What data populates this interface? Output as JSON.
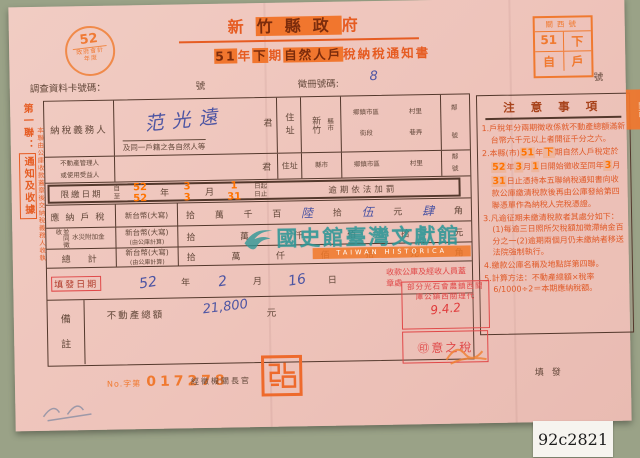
{
  "catalog_label": "92c2821",
  "stamp_52": {
    "number": "52",
    "line1": "政府會計",
    "line2": "年度"
  },
  "header": {
    "title_segs": [
      {
        "t": "新",
        "h": false
      },
      {
        "t": "竹縣政",
        "h": true
      },
      {
        "t": "府",
        "h": false
      }
    ],
    "subtitle_segs": [
      {
        "t": "51",
        "h": true
      },
      {
        "t": "年",
        "h": false
      },
      {
        "t": "下",
        "h": true
      },
      {
        "t": "期",
        "h": false
      },
      {
        "t": "自然人戶",
        "h": true
      },
      {
        "t": "稅納稅通知書",
        "h": false
      }
    ]
  },
  "corner_box": {
    "row1": "關西號",
    "r2a": "51",
    "r2b": "下",
    "r3a": "自",
    "r3b": "戶"
  },
  "card_row": {
    "label": "調查資料卡號碼：",
    "no1": "號",
    "reg_label": "徵冊號碼:",
    "reg_value": "8",
    "no2": "號"
  },
  "left_strip": {
    "part1": "第一聯：",
    "part2": "通知及收據",
    "sub": "本聯由公庫收款蓋章後交納稅義務人收執"
  },
  "form": {
    "taxpayer": {
      "label": "納稅義務人",
      "name": "范光遠",
      "jun": "君",
      "note": "及同一戶籍之各自然人等"
    },
    "addr": {
      "label": "住址",
      "city": "新竹",
      "city_unit": "縣市",
      "u1": "鄉鎮市區",
      "u2": "街段",
      "u3": "村里",
      "u4": "巷弄",
      "lin": "鄰",
      "hao": "號"
    },
    "manager": {
      "label1": "不動產管理人",
      "label2": "或使用受益人",
      "jun": "君",
      "addr_label": "住址",
      "city_unit": "縣市",
      "u1": "鄉鎮市區",
      "u2": "街段",
      "u3": "村里",
      "u4": "巷弄",
      "lin": "鄰",
      "hao": "號"
    },
    "deadline": {
      "label": "限繳日期",
      "from": "自",
      "to": "至",
      "year_from": "52",
      "year_to": "52",
      "y": "年",
      "month_from": "3",
      "month_to": "3",
      "m": "月",
      "day_from": "1",
      "day_to": "31",
      "suffix_from": "日起",
      "suffix_to": "日止",
      "penalty": "逾期依法加罰"
    },
    "tax_row": {
      "label": "應納戶稅",
      "currency": "新台幣(大寫)",
      "u1": "拾",
      "u2": "萬",
      "u3": "千",
      "u4": "百",
      "hw1": "陸",
      "u5": "拾",
      "hw2": "伍",
      "u6": "元",
      "hw3": "肆",
      "u7": "角"
    },
    "surtax_row": {
      "label_a": "並同徵收",
      "label_b": "水災附加金",
      "currency": "新台幣(大寫)",
      "currency2": "(由公庫計算)",
      "units": [
        "拾",
        "萬",
        "仟",
        "佰",
        "拾",
        "元"
      ]
    },
    "total_row": {
      "label": "總　計",
      "currency": "新台幣(大寫)",
      "currency2": "(由公庫計算)",
      "units": [
        "拾",
        "萬",
        "仟",
        "佰",
        "拾",
        "元",
        "角"
      ]
    },
    "issue": {
      "label": "填發日期",
      "year_hw": "52",
      "y": "年",
      "month_hw": "2",
      "m": "月",
      "day_hw": "16",
      "d": "日",
      "right_label": "收款公庫及經收人員蓋章處"
    },
    "remark": {
      "label1": "備",
      "label2": "註",
      "text": "不動產總額",
      "value_hw": "21,800",
      "unit": "元"
    }
  },
  "notes": {
    "title": "注 意 事 項",
    "items": [
      [
        {
          "t": "1.戶稅年分兩期徵收係就不動產總額滿新台幣六千元以上者開征千分之六。",
          "h": false
        }
      ],
      [
        {
          "t": "2.本縣(市)",
          "h": false
        },
        {
          "t": "51",
          "h": true
        },
        {
          "t": "年",
          "h": false
        },
        {
          "t": "下",
          "h": true
        },
        {
          "t": "期自然人戶稅定於",
          "h": false
        },
        {
          "t": "52",
          "h": true
        },
        {
          "t": "年",
          "h": false
        },
        {
          "t": "3",
          "h": true
        },
        {
          "t": "月",
          "h": false
        },
        {
          "t": "1",
          "h": true
        },
        {
          "t": "日開始徵收至同年",
          "h": false
        },
        {
          "t": "3",
          "h": true
        },
        {
          "t": "月",
          "h": false
        },
        {
          "t": "31",
          "h": true
        },
        {
          "t": "日止憑持本五聯納稅通知書向收款公庫繳清稅款後再由公庫發給第四聯憑單作為納稅人完稅憑證。",
          "h": false
        }
      ],
      [
        {
          "t": "3.凡逾征期未繳清稅款者其處分如下：(1)每逾三日照所欠稅額加徵滯納金百分之一(2)逾期兩個月仍未繳納者移送法院強制執行。",
          "h": false
        }
      ],
      [
        {
          "t": "4.繳款公庫名稱及地點詳第四聯。",
          "h": false
        }
      ],
      [
        {
          "t": "5.計算方法：不動產總額×稅率6/1000÷2＝本期應納稅額。",
          "h": false
        }
      ]
    ]
  },
  "watermark": {
    "text": "國史館臺灣文獻館",
    "sub": "TAIWAN HISTORICA"
  },
  "stamps": {
    "bank_line1": "部分光石會農鎮西關",
    "bank_line2": "庫公鎮西關理代",
    "bank_date": "9.4.2",
    "seal2_text": "㊞意之稅",
    "addr_stamp_solid": "關西",
    "addr_stamp_ghost": "石光里"
  },
  "footer": {
    "no_prefix": "No.字第",
    "serial": "017278",
    "officer": "經徵機關長官",
    "check": "填發"
  }
}
